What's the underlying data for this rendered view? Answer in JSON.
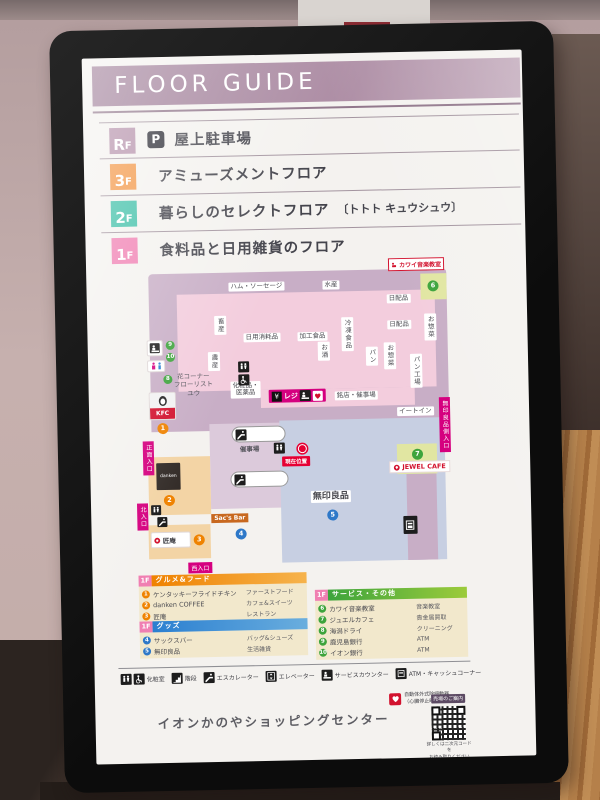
{
  "header": {
    "title": "FLOOR GUIDE"
  },
  "floors": [
    {
      "badge_main": "R",
      "badge_sub": "F",
      "parking_icon": "P",
      "label": "屋上駐車場"
    },
    {
      "badge_main": "3",
      "badge_sub": "F",
      "label": "アミューズメントフロア"
    },
    {
      "badge_main": "2",
      "badge_sub": "F",
      "label": "暮らしのセレクトフロア",
      "sublabel": "〔トトト キュウシュウ〕"
    },
    {
      "badge_main": "1",
      "badge_sub": "F",
      "label": "食料品と日用雑貨のフロア"
    }
  ],
  "map": {
    "labels": {
      "kawai": "カワイ音楽教室",
      "ham": "ハム・ソーセージ",
      "fish": "水産",
      "daily1": "日配品",
      "daily2": "日配品",
      "souzai_a": "お惣菜",
      "souzai_b": "お惣菜",
      "bakery_plant": "パン工場",
      "meat": "畜産",
      "produce": "農産",
      "daily_goods": "日用消耗品",
      "processed_food": "加工食品",
      "sake": "お酒",
      "frozen": "冷凍食品",
      "bread": "パン",
      "cosmetics_1": "化粧品・",
      "cosmetics_2": "医薬品",
      "yen": "¥",
      "register": "レジ",
      "meiten": "銘店・催事場",
      "eat_in": "イートイン",
      "flower_1": "花コーナー",
      "flower_2": "フローリスト",
      "flower_3": "ユウ",
      "event_hall": "催事場",
      "current_location": "現在位置",
      "muji": "無印良品",
      "sacs_bar": "Sac's Bar",
      "takumian": "匠庵",
      "jewel_cafe": "JEWEL CAFE",
      "kfc": "KFC",
      "danken": "danken"
    },
    "entrances": {
      "front": "正面入口",
      "north": "北入口",
      "west": "西入口",
      "muji_side": "無印良品側入口"
    },
    "markers": {
      "orange": [
        "1",
        "2",
        "3"
      ],
      "blue": [
        "4",
        "5"
      ],
      "green": [
        "6",
        "7",
        "8",
        "9",
        "10"
      ]
    }
  },
  "legend": {
    "gourmet": {
      "floor": "1F",
      "title": "グルメ&フード",
      "items": [
        {
          "num": "1",
          "name": "ケンタッキーフライドチキン",
          "category": "ファーストフード"
        },
        {
          "num": "2",
          "name": "danken COFFEE",
          "category": "カフェ&スイーツ"
        },
        {
          "num": "3",
          "name": "匠庵",
          "category": "レストラン"
        }
      ]
    },
    "goods": {
      "floor": "1F",
      "title": "グッズ",
      "items": [
        {
          "num": "4",
          "name": "サックスバー",
          "category": "バッグ&シューズ"
        },
        {
          "num": "5",
          "name": "無印良品",
          "category": "生活雑貨"
        }
      ]
    },
    "services": {
      "floor": "1F",
      "title": "サービス・その他",
      "items": [
        {
          "num": "6",
          "name": "カワイ音楽教室",
          "category": "音楽教室"
        },
        {
          "num": "7",
          "name": "ジュエルカフェ",
          "category": "貴金属買取"
        },
        {
          "num": "8",
          "name": "海潟ドライ",
          "category": "クリーニング"
        },
        {
          "num": "9",
          "name": "鹿児島銀行",
          "category": "ATM"
        },
        {
          "num": "10",
          "name": "イオン銀行",
          "category": "ATM"
        }
      ]
    }
  },
  "facilities": [
    {
      "label": "化粧室"
    },
    {
      "label": "階段"
    },
    {
      "label": "エスカレーター"
    },
    {
      "label": "エレベーター"
    },
    {
      "label": "サービスカウンター"
    },
    {
      "label": "ATM・キャッシュコーナー"
    }
  ],
  "aed": {
    "line1": "自動体外式除細動器",
    "line2": "（心臓停止時の救命装置）"
  },
  "footer": {
    "title": "イオンかのやショッピングセンター",
    "qr_badge": "売場のご案内",
    "qr_note1": "詳しくは二次元コードを",
    "qr_note2": "お読み取りください"
  },
  "colors": {
    "accent_magenta": "#d5007f",
    "header_mauve": "#9c7a95",
    "floor_rf": "#b48fa9",
    "floor_3f": "#f39543",
    "floor_2f": "#3cbfa7",
    "floor_1f": "#f07fb2",
    "legend_orange": "#ef8200",
    "legend_blue": "#2b7fd0",
    "legend_green": "#3da43c"
  }
}
